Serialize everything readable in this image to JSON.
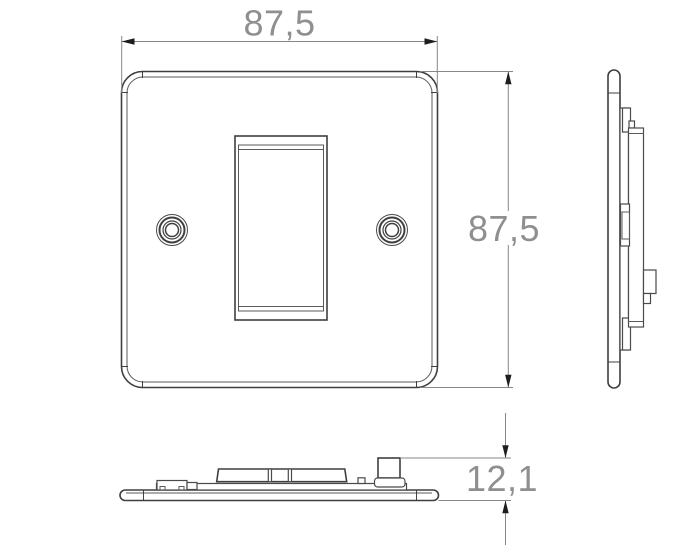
{
  "drawing": {
    "type": "technical-dimension-drawing",
    "subject": "single-gang rocker switch plate",
    "views": {
      "front": "front-view",
      "side": "side-profile-view",
      "bottom": "bottom-profile-view"
    },
    "dimensions": {
      "width": {
        "label": "87,5"
      },
      "height": {
        "label": "87,5"
      },
      "depth": {
        "label": "12,1"
      }
    },
    "colors": {
      "background": "#ffffff",
      "outline": "#3f3f3f",
      "secondary_line": "#5a5a5a",
      "dimension_line": "#878787",
      "dimension_text": "#8f8f8f",
      "arrowhead": "#1e1e1e"
    }
  }
}
